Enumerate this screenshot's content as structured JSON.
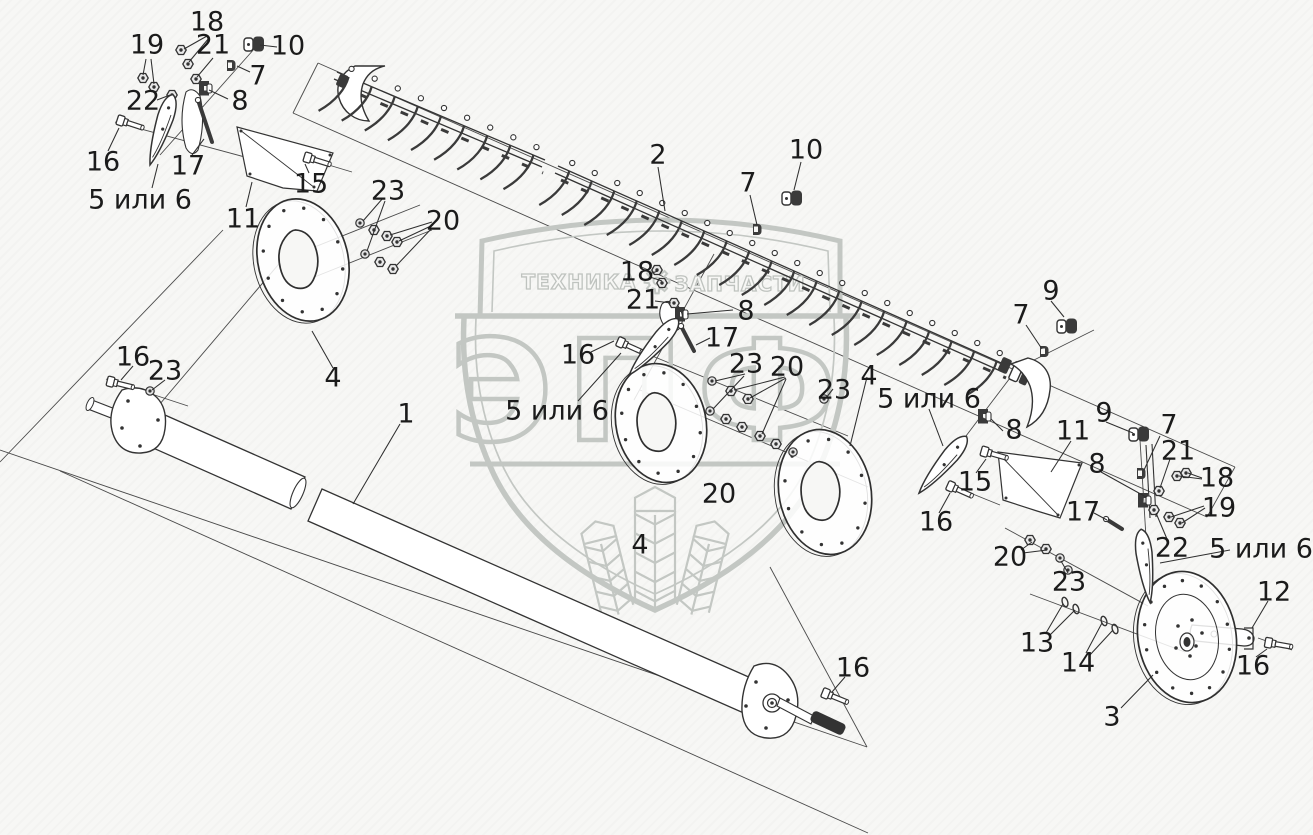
{
  "diagram": {
    "kind": "exploded-parts-diagram",
    "subject": "Cutter bar / knife drive and reel tube assembly"
  },
  "colors": {
    "background": "#f7f7f5",
    "line": "#3a3a3a",
    "label": "#1b1b1b",
    "watermark": "#c3c7c3"
  },
  "watermark": {
    "left_text": "ТЕХНИКА",
    "right_text": "ЗАПЧАСТИ",
    "big_text": "ЭПФ",
    "gear_icon": "gear-icon",
    "wheat_icon": "wheat-ears-icon"
  },
  "callouts": [
    {
      "t": "18",
      "x": 207,
      "y": 22
    },
    {
      "t": "19",
      "x": 147,
      "y": 45
    },
    {
      "t": "21",
      "x": 213,
      "y": 45
    },
    {
      "t": "10",
      "x": 288,
      "y": 46
    },
    {
      "t": "7",
      "x": 258,
      "y": 76
    },
    {
      "t": "22",
      "x": 143,
      "y": 101
    },
    {
      "t": "8",
      "x": 240,
      "y": 101
    },
    {
      "t": "16",
      "x": 103,
      "y": 162
    },
    {
      "t": "17",
      "x": 188,
      "y": 166
    },
    {
      "t": "5 или 6",
      "x": 140,
      "y": 200
    },
    {
      "t": "15",
      "x": 311,
      "y": 184
    },
    {
      "t": "11",
      "x": 243,
      "y": 219
    },
    {
      "t": "23",
      "x": 388,
      "y": 191
    },
    {
      "t": "20",
      "x": 443,
      "y": 221
    },
    {
      "t": "2",
      "x": 658,
      "y": 155
    },
    {
      "t": "10",
      "x": 806,
      "y": 150
    },
    {
      "t": "7",
      "x": 748,
      "y": 183
    },
    {
      "t": "18",
      "x": 637,
      "y": 272
    },
    {
      "t": "21",
      "x": 643,
      "y": 300
    },
    {
      "t": "8",
      "x": 746,
      "y": 311
    },
    {
      "t": "16",
      "x": 578,
      "y": 355
    },
    {
      "t": "17",
      "x": 722,
      "y": 338
    },
    {
      "t": "5 или 6",
      "x": 557,
      "y": 411
    },
    {
      "t": "23",
      "x": 746,
      "y": 364
    },
    {
      "t": "20",
      "x": 787,
      "y": 367
    },
    {
      "t": "23",
      "x": 834,
      "y": 390
    },
    {
      "t": "4",
      "x": 869,
      "y": 376
    },
    {
      "t": "9",
      "x": 1051,
      "y": 291
    },
    {
      "t": "7",
      "x": 1021,
      "y": 315
    },
    {
      "t": "16",
      "x": 133,
      "y": 357
    },
    {
      "t": "23",
      "x": 165,
      "y": 371
    },
    {
      "t": "4",
      "x": 333,
      "y": 378
    },
    {
      "t": "1",
      "x": 406,
      "y": 414
    },
    {
      "t": "5 или 6",
      "x": 929,
      "y": 399
    },
    {
      "t": "8",
      "x": 1014,
      "y": 430
    },
    {
      "t": "11",
      "x": 1073,
      "y": 431
    },
    {
      "t": "9",
      "x": 1104,
      "y": 413
    },
    {
      "t": "7",
      "x": 1169,
      "y": 425
    },
    {
      "t": "21",
      "x": 1178,
      "y": 451
    },
    {
      "t": "18",
      "x": 1217,
      "y": 478
    },
    {
      "t": "8",
      "x": 1097,
      "y": 464
    },
    {
      "t": "15",
      "x": 975,
      "y": 482
    },
    {
      "t": "16",
      "x": 936,
      "y": 522
    },
    {
      "t": "17",
      "x": 1083,
      "y": 512
    },
    {
      "t": "19",
      "x": 1219,
      "y": 508
    },
    {
      "t": "22",
      "x": 1172,
      "y": 548
    },
    {
      "t": "5 или 6",
      "x": 1261,
      "y": 549
    },
    {
      "t": "20",
      "x": 1010,
      "y": 557
    },
    {
      "t": "23",
      "x": 1069,
      "y": 582
    },
    {
      "t": "12",
      "x": 1274,
      "y": 592
    },
    {
      "t": "20",
      "x": 719,
      "y": 494
    },
    {
      "t": "4",
      "x": 640,
      "y": 545
    },
    {
      "t": "13",
      "x": 1037,
      "y": 643
    },
    {
      "t": "14",
      "x": 1078,
      "y": 663
    },
    {
      "t": "16",
      "x": 1253,
      "y": 666
    },
    {
      "t": "3",
      "x": 1112,
      "y": 717
    },
    {
      "t": "16",
      "x": 853,
      "y": 668
    }
  ],
  "leaders": [
    [
      207,
      36,
      184,
      49
    ],
    [
      209,
      38,
      189,
      62
    ],
    [
      146,
      59,
      143,
      75
    ],
    [
      151,
      59,
      154,
      84
    ],
    [
      213,
      58,
      197,
      77
    ],
    [
      277,
      47,
      260,
      45
    ],
    [
      250,
      72,
      237,
      66
    ],
    [
      157,
      100,
      170,
      95
    ],
    [
      228,
      99,
      209,
      90
    ],
    [
      108,
      151,
      119,
      128
    ],
    [
      192,
      155,
      204,
      139
    ],
    [
      152,
      188,
      158,
      164
    ],
    [
      309,
      173,
      305,
      164
    ],
    [
      246,
      207,
      252,
      182
    ],
    [
      383,
      198,
      363,
      221
    ],
    [
      385,
      201,
      367,
      251
    ],
    [
      432,
      222,
      390,
      235
    ],
    [
      433,
      225,
      399,
      241
    ],
    [
      432,
      228,
      396,
      266
    ],
    [
      658,
      167,
      665,
      211
    ],
    [
      801,
      162,
      794,
      190
    ],
    [
      750,
      195,
      757,
      225
    ],
    [
      649,
      274,
      658,
      271
    ],
    [
      650,
      277,
      662,
      281
    ],
    [
      655,
      301,
      671,
      303
    ],
    [
      733,
      310,
      687,
      314
    ],
    [
      591,
      352,
      614,
      341
    ],
    [
      710,
      338,
      696,
      345
    ],
    [
      578,
      401,
      621,
      353
    ],
    [
      745,
      374,
      715,
      381
    ],
    [
      744,
      376,
      713,
      409
    ],
    [
      785,
      377,
      734,
      390
    ],
    [
      786,
      378,
      750,
      398
    ],
    [
      786,
      379,
      762,
      434
    ],
    [
      833,
      389,
      826,
      398
    ],
    [
      867,
      377,
      850,
      446
    ],
    [
      1051,
      301,
      1064,
      317
    ],
    [
      1026,
      325,
      1042,
      349
    ],
    [
      133,
      366,
      121,
      380
    ],
    [
      165,
      380,
      152,
      390
    ],
    [
      333,
      368,
      312,
      331
    ],
    [
      400,
      424,
      353,
      504
    ],
    [
      929,
      409,
      943,
      446
    ],
    [
      1003,
      431,
      991,
      419
    ],
    [
      1071,
      441,
      1051,
      472
    ],
    [
      1106,
      422,
      1133,
      433
    ],
    [
      1160,
      436,
      1144,
      470
    ],
    [
      1170,
      459,
      1160,
      488
    ],
    [
      1202,
      478,
      1188,
      473
    ],
    [
      1202,
      479,
      1179,
      476
    ],
    [
      1101,
      472,
      1146,
      497
    ],
    [
      976,
      473,
      986,
      459
    ],
    [
      939,
      513,
      950,
      493
    ],
    [
      1094,
      513,
      1107,
      520
    ],
    [
      1205,
      508,
      1182,
      523
    ],
    [
      1204,
      506,
      1171,
      517
    ],
    [
      1167,
      539,
      1156,
      513
    ],
    [
      1230,
      550,
      1160,
      563
    ],
    [
      1021,
      550,
      1032,
      542
    ],
    [
      1023,
      553,
      1047,
      550
    ],
    [
      1068,
      573,
      1061,
      561
    ],
    [
      1268,
      601,
      1252,
      628
    ],
    [
      1046,
      633,
      1063,
      604
    ],
    [
      1049,
      636,
      1075,
      610
    ],
    [
      1086,
      653,
      1102,
      623
    ],
    [
      1089,
      656,
      1113,
      630
    ],
    [
      1256,
      657,
      1267,
      649
    ],
    [
      1121,
      708,
      1153,
      675
    ],
    [
      845,
      677,
      832,
      692
    ]
  ],
  "parts": {
    "nuts": [
      [
        181,
        50
      ],
      [
        188,
        64
      ],
      [
        196,
        79
      ],
      [
        143,
        78
      ],
      [
        154,
        87
      ],
      [
        172,
        95
      ],
      [
        657,
        270
      ],
      [
        662,
        283
      ],
      [
        674,
        303
      ],
      [
        374,
        230
      ],
      [
        387,
        236
      ],
      [
        397,
        242
      ],
      [
        380,
        262
      ],
      [
        393,
        269
      ],
      [
        731,
        391
      ],
      [
        748,
        399
      ],
      [
        726,
        419
      ],
      [
        742,
        427
      ],
      [
        760,
        436
      ],
      [
        776,
        444
      ],
      [
        1030,
        540
      ],
      [
        1046,
        549
      ],
      [
        1159,
        491
      ],
      [
        1177,
        476
      ],
      [
        1186,
        473
      ],
      [
        1169,
        517
      ],
      [
        1180,
        523
      ],
      [
        1154,
        510
      ]
    ],
    "washers": [
      [
        360,
        223
      ],
      [
        365,
        254
      ],
      [
        712,
        381
      ],
      [
        824,
        399
      ],
      [
        710,
        411
      ],
      [
        793,
        452
      ],
      [
        150,
        391
      ],
      [
        1060,
        558
      ],
      [
        1068,
        570
      ]
    ],
    "rings": [
      [
        1065,
        602
      ],
      [
        1076,
        609
      ],
      [
        1104,
        621
      ],
      [
        1115,
        629
      ]
    ],
    "bolts": [
      [
        122,
        121,
        18
      ],
      [
        309,
        158,
        17
      ],
      [
        112,
        382,
        14
      ],
      [
        622,
        343,
        24
      ],
      [
        986,
        452,
        16
      ],
      [
        952,
        487,
        24
      ],
      [
        1270,
        643,
        10
      ],
      [
        827,
        694,
        22
      ]
    ],
    "clamps_small": [
      [
        231,
        65
      ],
      [
        757,
        229
      ],
      [
        1044,
        351
      ],
      [
        1141,
        473
      ]
    ],
    "clamps_mid": [
      [
        205,
        88
      ],
      [
        681,
        314
      ],
      [
        984,
        416
      ],
      [
        1144,
        500
      ]
    ],
    "clamps_big": [
      [
        254,
        44
      ],
      [
        792,
        198
      ],
      [
        1067,
        326
      ],
      [
        1139,
        434
      ]
    ],
    "rods": [
      [
        198,
        100,
        212,
        142
      ],
      [
        681,
        326,
        694,
        351
      ],
      [
        1106,
        519,
        1122,
        529
      ]
    ],
    "blades": [
      [
        163,
        125,
        108
      ],
      [
        657,
        343,
        131
      ],
      [
        946,
        461,
        130
      ],
      [
        1145,
        561,
        83
      ]
    ]
  },
  "cutter_bar": {
    "segments": [
      {
        "x1": 337,
        "y1": 72,
        "x2": 545,
        "y2": 160,
        "teeth": 9
      },
      {
        "x1": 558,
        "y1": 166,
        "x2": 1008,
        "y2": 366,
        "teeth": 20
      }
    ]
  },
  "discs": [
    {
      "cx": 303,
      "cy": 260,
      "rx": 45,
      "ry": 62,
      "rot": -14,
      "dots": 12,
      "type": "tri"
    },
    {
      "cx": 661,
      "cy": 423,
      "rx": 45,
      "ry": 60,
      "rot": -12,
      "dots": 12,
      "type": "tri"
    },
    {
      "cx": 825,
      "cy": 492,
      "rx": 46,
      "ry": 63,
      "rot": -11,
      "dots": 12,
      "type": "tri"
    },
    {
      "cx": 1187,
      "cy": 637,
      "rx": 49,
      "ry": 66,
      "rot": -10,
      "dots": 14,
      "type": "hub"
    }
  ]
}
